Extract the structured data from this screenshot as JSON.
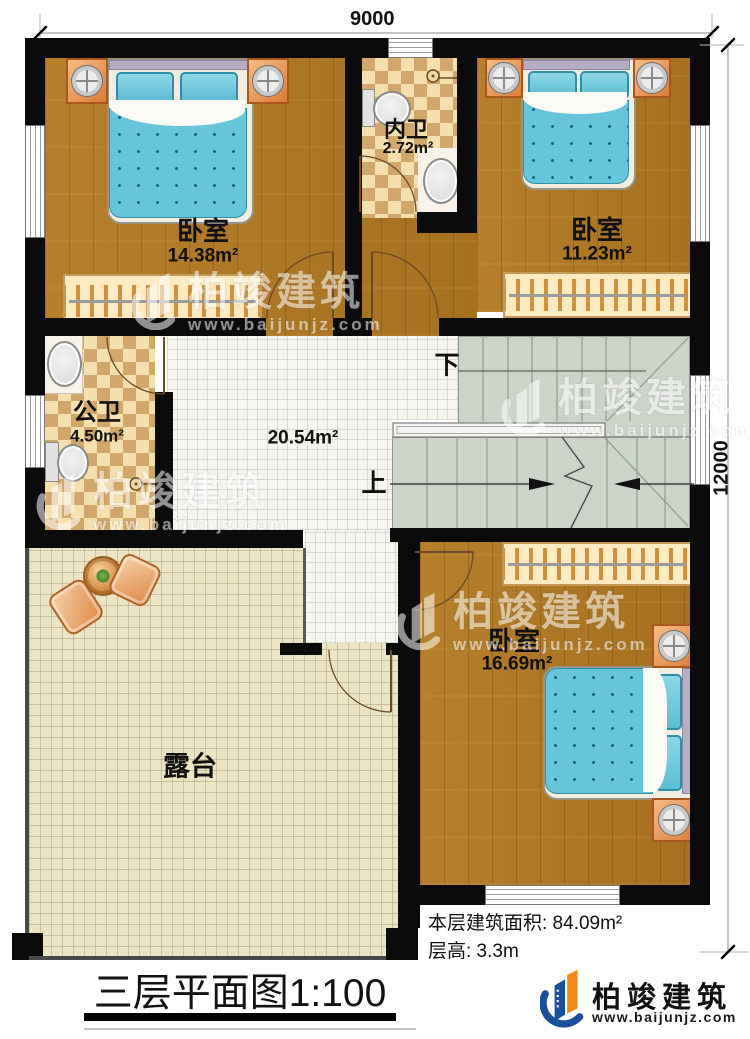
{
  "plan": {
    "dim_top": "9000",
    "dim_right": "12000",
    "rooms": [
      {
        "id": "bedroom-top-left",
        "name": "卧室",
        "area": "14.38m²"
      },
      {
        "id": "inner-bathroom",
        "name": "内卫",
        "area": "2.72m²"
      },
      {
        "id": "bedroom-top-right",
        "name": "卧室",
        "area": "11.23m²"
      },
      {
        "id": "public-bathroom",
        "name": "公卫",
        "area": "4.50m²"
      },
      {
        "id": "hall",
        "name": "",
        "area": "20.54m²"
      },
      {
        "id": "bedroom-bottom",
        "name": "卧室",
        "area": "16.69m²"
      },
      {
        "id": "terrace",
        "name": "露台",
        "area": ""
      }
    ],
    "stair_down": "下",
    "stair_up": "上"
  },
  "footer": {
    "area_line": "本层建筑面积: 84.09m²",
    "height_line": "层高: 3.3m",
    "title": "三层平面图1:100"
  },
  "brand": {
    "name": "柏竣建筑",
    "url": "www.baijunjz.com",
    "colors": {
      "blue": "#1b4e9b",
      "orange": "#f28a18"
    }
  },
  "watermark": {
    "name": "柏竣建筑",
    "url": "www.baijunjz.com"
  }
}
